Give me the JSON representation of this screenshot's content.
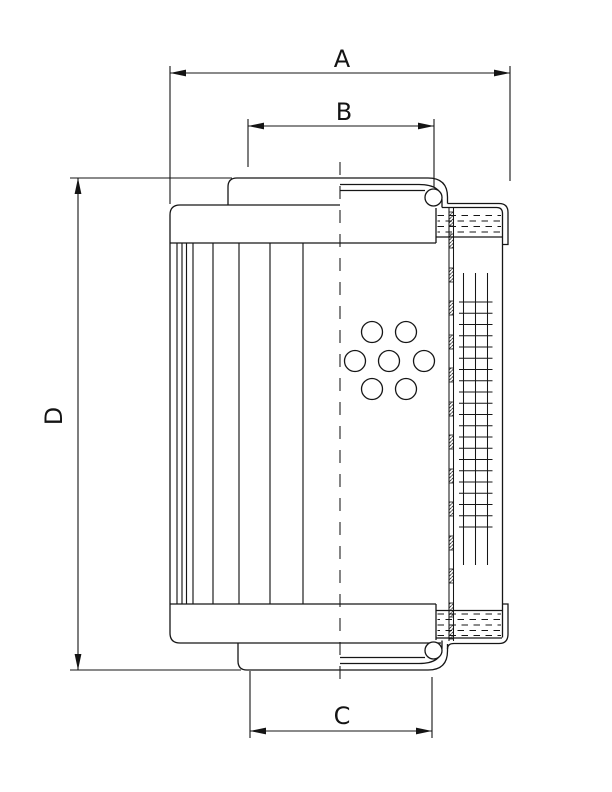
{
  "drawing": {
    "type": "technical-dimension-drawing",
    "subject": "filter-element-cross-section",
    "dimensions": {
      "a": {
        "label": "A"
      },
      "b": {
        "label": "B"
      },
      "c": {
        "label": "C"
      },
      "d": {
        "label": "D"
      }
    },
    "colors": {
      "line": "#141414",
      "background": "#ffffff"
    }
  }
}
